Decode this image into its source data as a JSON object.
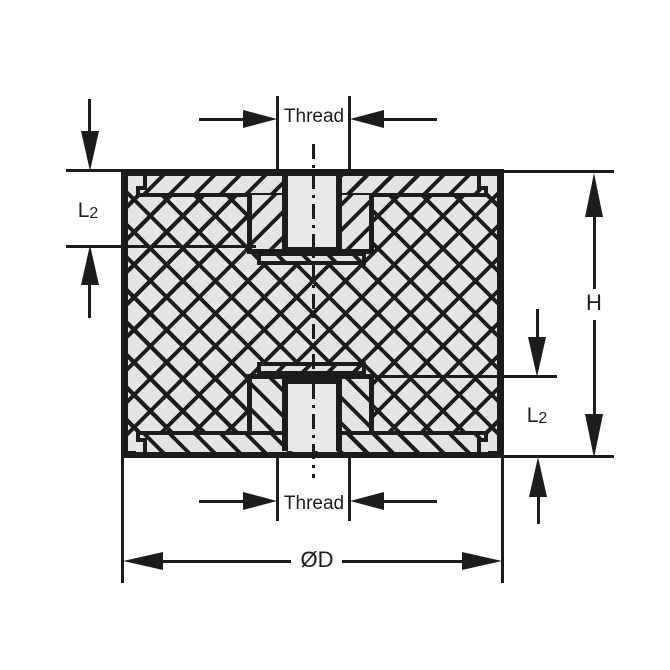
{
  "drawing": {
    "title": "Rubber mount cross-section",
    "labels": {
      "thread": "Thread",
      "l2": {
        "main": "L",
        "sub": "2"
      },
      "height": "H",
      "diameter": "ØD"
    },
    "colors": {
      "ink": "#1c1c1c",
      "rubber_fill": "#e4e4e4",
      "hole_fill": "#e9e9e9",
      "background": "#ffffff"
    }
  }
}
